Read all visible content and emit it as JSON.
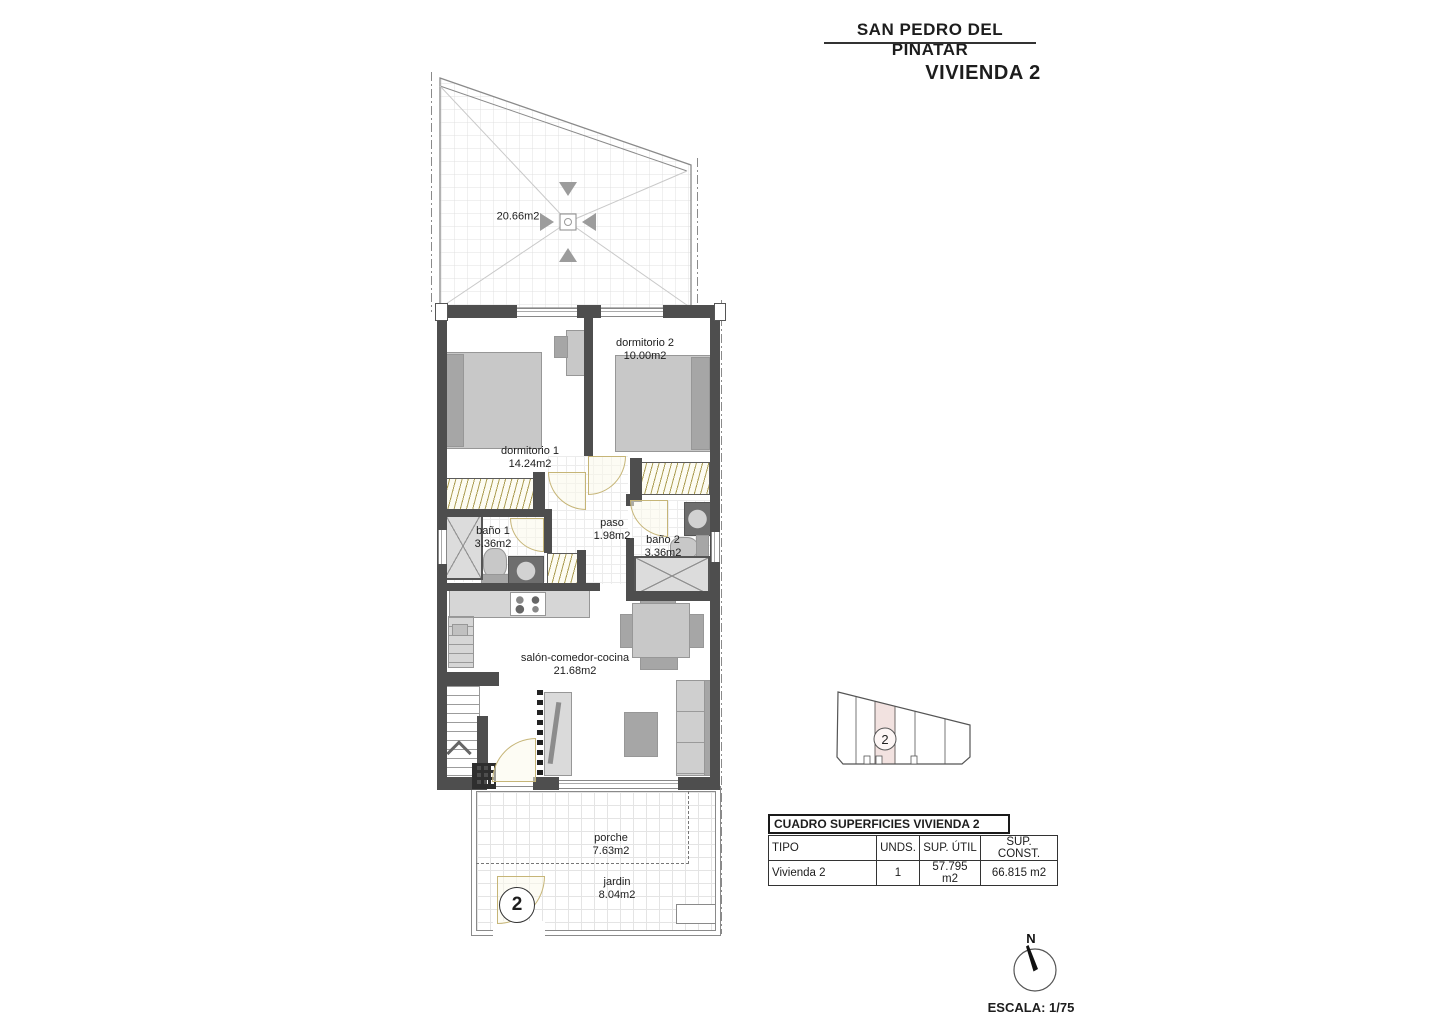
{
  "header": {
    "location_title": "SAN PEDRO DEL PINATAR",
    "unit_title": "VIVIENDA 2"
  },
  "rooms": {
    "solarium": {
      "area": "20.66m2"
    },
    "dormitorio1": {
      "name": "dormitorio 1",
      "area": "14.24m2"
    },
    "dormitorio2": {
      "name": "dormitorio 2",
      "area": "10.00m2"
    },
    "bano1": {
      "name": "baño 1",
      "area": "3.36m2"
    },
    "bano2": {
      "name": "baño 2",
      "area": "3.36m2"
    },
    "paso": {
      "name": "paso",
      "area": "1.98m2"
    },
    "salon": {
      "name": "salón-comedor-cocina",
      "area": "21.68m2"
    },
    "porche": {
      "name": "porche",
      "area": "7.63m2"
    },
    "jardin": {
      "name": "jardin",
      "area": "8.04m2"
    }
  },
  "markers": {
    "jardin_unit_number": "2",
    "siteplan_unit_number": "2"
  },
  "surface_table": {
    "title": "CUADRO SUPERFICIES VIVIENDA 2",
    "columns": [
      "TIPO",
      "UNDS.",
      "SUP. ÚTIL",
      "SUP. CONST."
    ],
    "rows": [
      [
        "Vivienda 2",
        "1",
        "57.795 m2",
        "66.815 m2"
      ]
    ]
  },
  "compass": {
    "north_label": "N"
  },
  "scale_label": "ESCALA: 1/75",
  "colors": {
    "wall": "#4e4e4e",
    "furniture": "#c8c8c8",
    "door": "#c6b577",
    "site_highlight": "#f2e2e0"
  }
}
